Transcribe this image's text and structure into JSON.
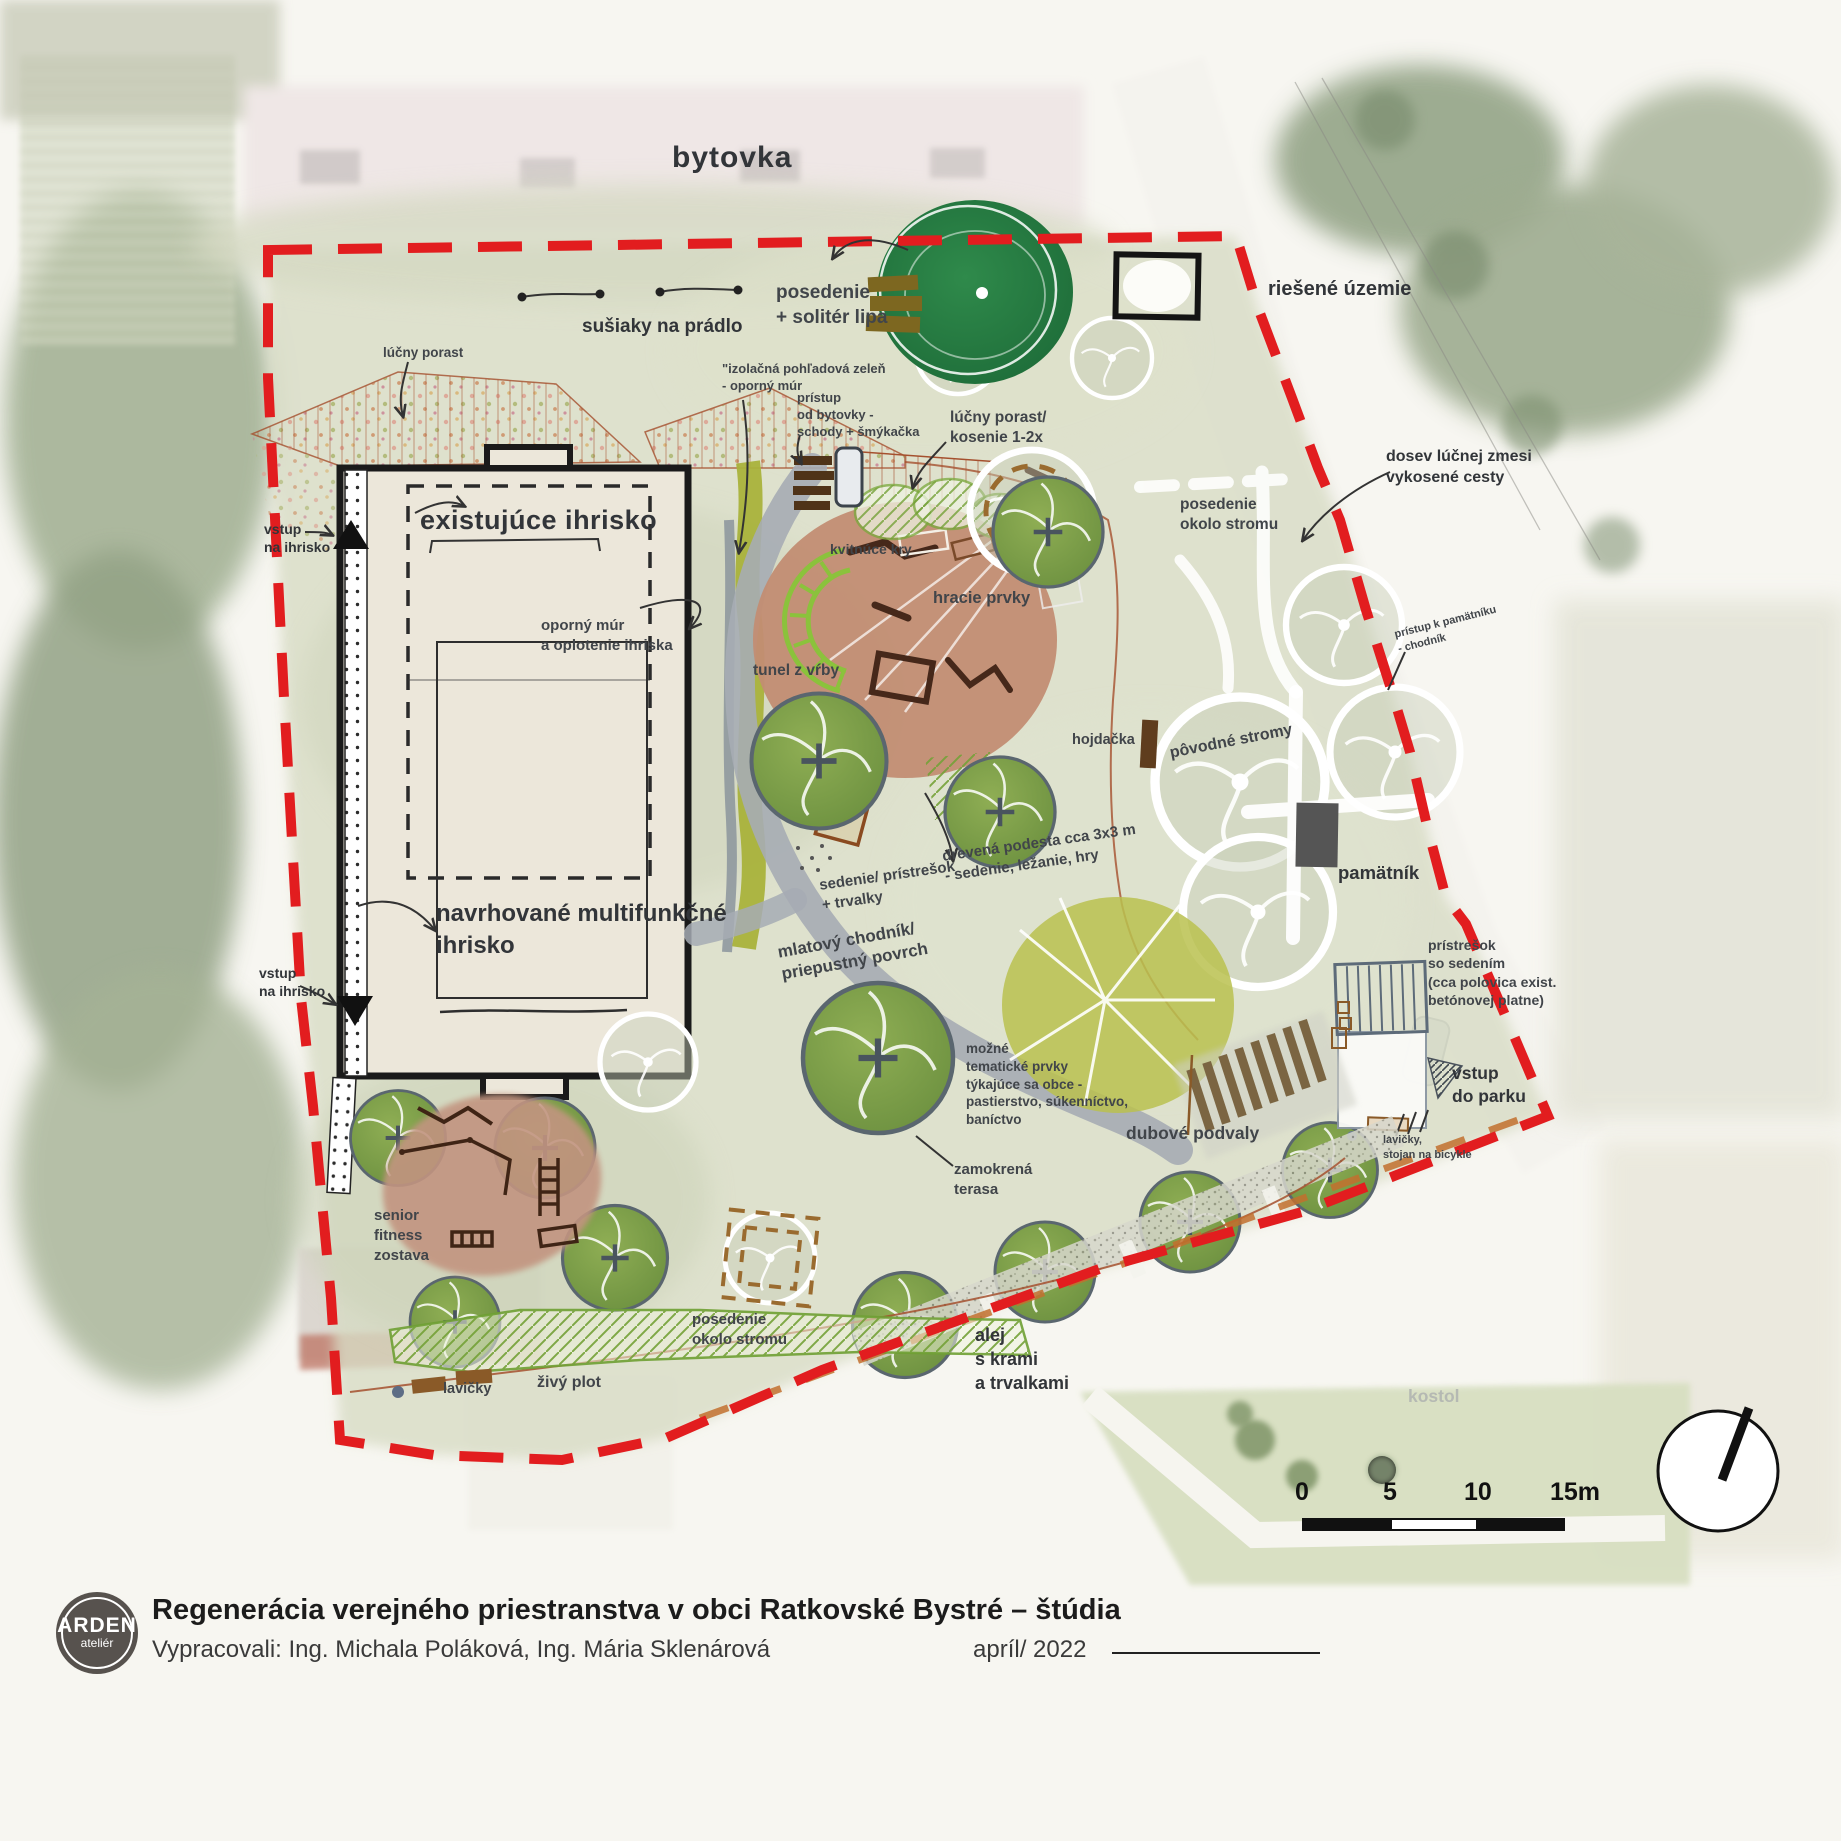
{
  "title_block": {
    "logo_top": "ARDEN",
    "logo_bottom": "ateliér",
    "title": "Regenerácia verejného priestranstva v obci Ratkovské Bystré – štúdia",
    "authors": "Vypracovali: Ing. Michala Poláková, Ing. Mária Sklenárová",
    "date": "apríl/ 2022"
  },
  "scalebar": {
    "n0": "0",
    "n5": "5",
    "n10": "10",
    "n15": "15m"
  },
  "labels": {
    "bytovka": "bytovka",
    "posedenie_lipa": "posedenie\n+ solitér lipa",
    "susiaky": "sušiaky na prádlo",
    "riesene_uzemie": "riešené územie",
    "lucny_porast": "lúčny porast",
    "izolacna": "\"izolačná pohľadová zeleň\n- oporný múr",
    "pristup_bytovky": "prístup\nod bytovky -\nschody + šmýkačka",
    "kosenie": "lúčny porast/\nkosenie 1-2x",
    "vstup_ihrisko_1": "vstup\nna ihrisko",
    "existujuce_ihrisko": "existujúce ihrisko",
    "kvitnuce_kry": "kvitnúce kry",
    "posedenie_stromu_1": "posedenie\nokolo stromu",
    "dosev": "dosev lúčnej zmesi\nvykosené cesty",
    "hracie_prvky": "hracie prvky",
    "oporny_mur": "oporný múr\na oplotenie ihriska",
    "tunel_vrby": "tunel z vŕby",
    "pristup_pamatniku": "prístup k pamätníku\n- chodník",
    "hojdacka": "hojdačka",
    "povodne_stromy": "pôvodné stromy",
    "pamatnik": "pamätník",
    "sedenie_pristresok": "sedenie/ prístrešok\n+ trvalky",
    "drevena_podesta": "drevená podesta cca 3x3 m\n- sedenie, ležanie, hry",
    "navrhovane": "navrhované multifunkčné\nihrisko",
    "vstup_ihrisko_2": "vstup\nna ihrisko",
    "mlatovy": "mlatový chodník/\npriepustný povrch",
    "mozne_tematicke": "možné\ntematické prvky\ntýkajúce sa obce -\npastierstvo, súkenníctvo,\nbaníctvo",
    "dubove_podvaly": "dubové podvaly",
    "zamokrena": "zamokrená\nterasa",
    "pristresok_sedenim": "prístrešok\nso sedením\n(cca polovica exist.\nbetónovej platne)",
    "vstup_parku": "vstup\ndo parku",
    "lavicky_stojan": "lavičky,\nstojan na bicykle",
    "senior_fitness": "senior\nfitness\nzostava",
    "posedenie_stromu_2": "posedenie\nokolo stromu",
    "lavicky": "lavičky",
    "zivy_plot": "živý plot",
    "alej": "alej\ns krami\na trvalkami",
    "kostol": "kostol"
  },
  "colors": {
    "boundary_red": "#e21d1f",
    "ochre_dash": "#c2702e",
    "path_gray": "#a6acb4",
    "play_area_brown": "#c28d73",
    "tree_green": "#7fa04b",
    "planting_olive": "#a9b23b"
  }
}
